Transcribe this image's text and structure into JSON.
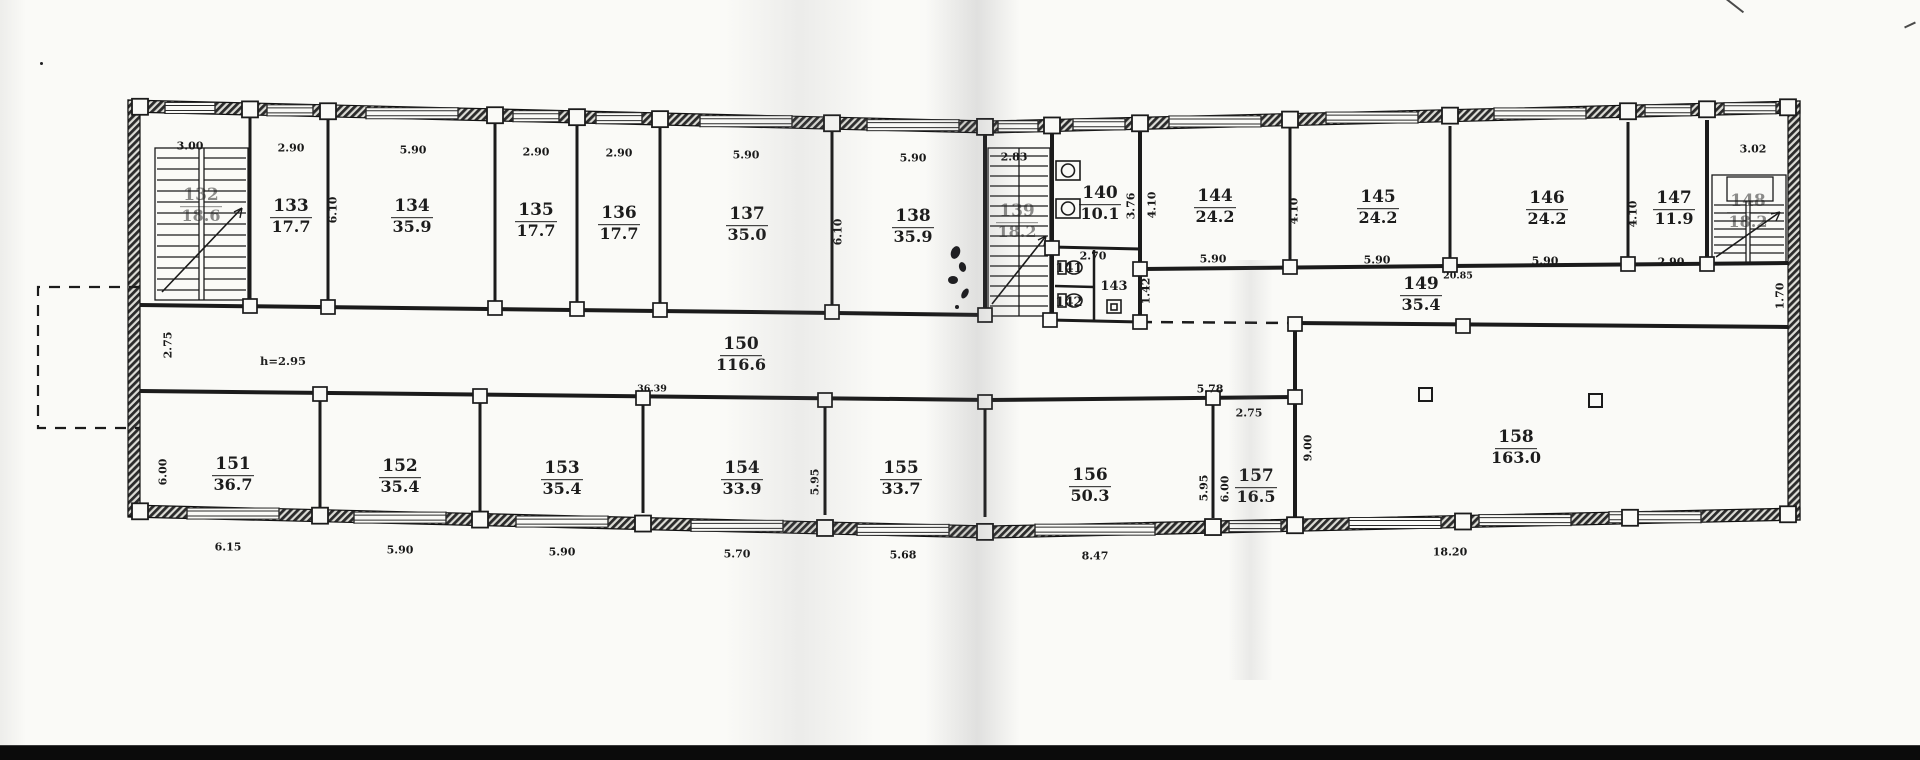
{
  "drawing_title": "",
  "colors": {
    "ink": "#1a1a1a",
    "paper": "#fafaf7",
    "wall_fill": "#3a3a3a"
  },
  "rooms": [
    {
      "number": "132",
      "area": "18.6",
      "obscured": true,
      "kind": "stairwell"
    },
    {
      "number": "133",
      "area": "17.7",
      "obscured": false,
      "kind": "room"
    },
    {
      "number": "134",
      "area": "35.9",
      "obscured": false,
      "kind": "room"
    },
    {
      "number": "135",
      "area": "17.7",
      "obscured": false,
      "kind": "room"
    },
    {
      "number": "136",
      "area": "17.7",
      "obscured": false,
      "kind": "room"
    },
    {
      "number": "137",
      "area": "35.0",
      "obscured": false,
      "kind": "room"
    },
    {
      "number": "138",
      "area": "35.9",
      "obscured": false,
      "kind": "room"
    },
    {
      "number": "139",
      "area": "18.2",
      "obscured": true,
      "kind": "stairwell"
    },
    {
      "number": "140",
      "area": "10.1",
      "obscured": false,
      "kind": "washroom"
    },
    {
      "number": "141",
      "area": "",
      "obscured": false,
      "kind": "wc"
    },
    {
      "number": "142",
      "area": "",
      "obscured": false,
      "kind": "wc"
    },
    {
      "number": "143",
      "area": "",
      "obscured": false,
      "kind": "room"
    },
    {
      "number": "144",
      "area": "24.2",
      "obscured": false,
      "kind": "room"
    },
    {
      "number": "145",
      "area": "24.2",
      "obscured": false,
      "kind": "room"
    },
    {
      "number": "146",
      "area": "24.2",
      "obscured": false,
      "kind": "room"
    },
    {
      "number": "147",
      "area": "11.9",
      "obscured": false,
      "kind": "room"
    },
    {
      "number": "148",
      "area": "18.2",
      "obscured": true,
      "kind": "stairwell"
    },
    {
      "number": "149",
      "area": "35.4",
      "obscured": false,
      "kind": "corridor"
    },
    {
      "number": "150",
      "area": "116.6",
      "obscured": false,
      "kind": "corridor"
    },
    {
      "number": "151",
      "area": "36.7",
      "obscured": false,
      "kind": "room"
    },
    {
      "number": "152",
      "area": "35.4",
      "obscured": false,
      "kind": "room"
    },
    {
      "number": "153",
      "area": "35.4",
      "obscured": false,
      "kind": "room"
    },
    {
      "number": "154",
      "area": "33.9",
      "obscured": false,
      "kind": "room"
    },
    {
      "number": "155",
      "area": "33.7",
      "obscured": false,
      "kind": "room"
    },
    {
      "number": "156",
      "area": "50.3",
      "obscured": false,
      "kind": "room"
    },
    {
      "number": "157",
      "area": "16.5",
      "obscured": false,
      "kind": "room"
    },
    {
      "number": "158",
      "area": "163.0",
      "obscured": false,
      "kind": "hall"
    }
  ],
  "dimensions": [
    {
      "value": "3.00"
    },
    {
      "value": "2.90"
    },
    {
      "value": "5.90"
    },
    {
      "value": "2.90"
    },
    {
      "value": "2.90"
    },
    {
      "value": "5.90"
    },
    {
      "value": "5.90"
    },
    {
      "value": "2.83"
    },
    {
      "value": "3.02"
    },
    {
      "value": "6.10"
    },
    {
      "value": "6.10"
    },
    {
      "value": "3.76"
    },
    {
      "value": "2.70"
    },
    {
      "value": "1.42"
    },
    {
      "value": "4.10"
    },
    {
      "value": "5.90"
    },
    {
      "value": "4.10"
    },
    {
      "value": "5.90"
    },
    {
      "value": "5.90"
    },
    {
      "value": "4.10"
    },
    {
      "value": "2.90"
    },
    {
      "value": "20.85"
    },
    {
      "value": "1.70"
    },
    {
      "value": "2.75"
    },
    {
      "value": "36.39"
    },
    {
      "value": "5.78"
    },
    {
      "value": "2.75"
    },
    {
      "value": "9.00"
    },
    {
      "value": "6.00"
    },
    {
      "value": "5.95"
    },
    {
      "value": "5.95"
    },
    {
      "value": "6.00"
    },
    {
      "value": "6.15"
    },
    {
      "value": "5.90"
    },
    {
      "value": "5.90"
    },
    {
      "value": "5.70"
    },
    {
      "value": "5.68"
    },
    {
      "value": "8.47"
    },
    {
      "value": "18.20"
    }
  ],
  "annotations": [
    {
      "text": "h=2.95"
    }
  ]
}
